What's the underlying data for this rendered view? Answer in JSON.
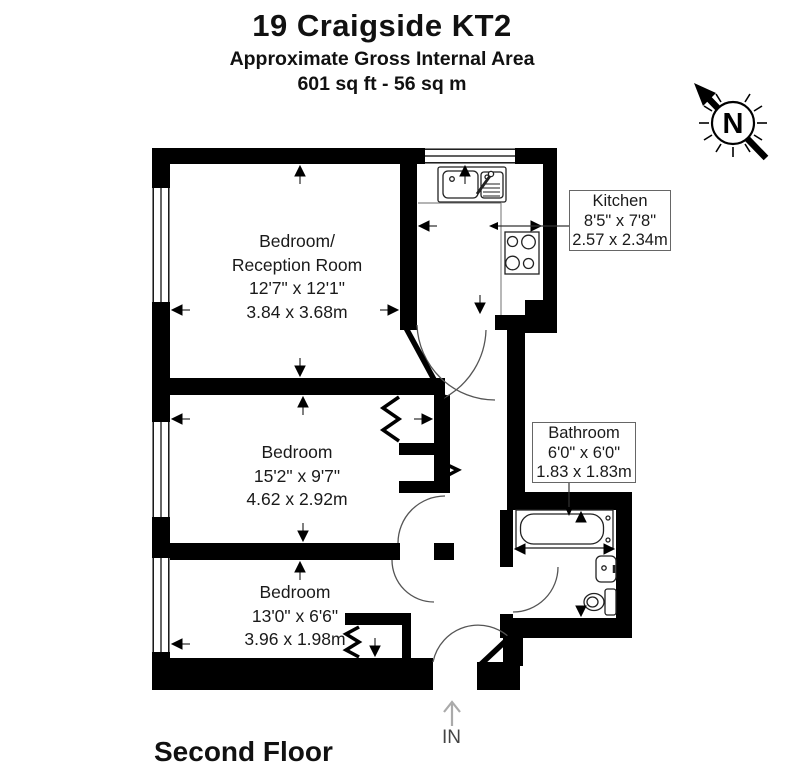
{
  "title": {
    "line1": "19 Craigside KT2",
    "line2": "Approximate Gross Internal Area",
    "line3": "601 sq ft - 56 sq m"
  },
  "compass": {
    "letter": "N"
  },
  "rooms": {
    "bedroom_reception": {
      "name_line1": "Bedroom/",
      "name_line2": "Reception Room",
      "imperial": "12'7\" x 12'1\"",
      "metric": "3.84 x 3.68m"
    },
    "bedroom2": {
      "name": "Bedroom",
      "imperial": "15'2\" x 9'7\"",
      "metric": "4.62 x 2.92m"
    },
    "bedroom3": {
      "name": "Bedroom",
      "imperial": "13'0\" x 6'6\"",
      "metric": "3.96 x 1.98m"
    },
    "kitchen": {
      "name": "Kitchen",
      "imperial": "8'5\" x 7'8\"",
      "metric": "2.57 x 2.34m"
    },
    "bathroom": {
      "name": "Bathroom",
      "imperial": "6'0\" x 6'0\"",
      "metric": "1.83 x 1.83m"
    }
  },
  "footer": {
    "floor_label": "Second Floor",
    "entrance_label": "IN"
  },
  "colors": {
    "wall": "#000000",
    "background": "#ffffff",
    "fixture_line": "#222222",
    "door_arc": "#555555",
    "entry_arrow": "#aaaaaa"
  }
}
